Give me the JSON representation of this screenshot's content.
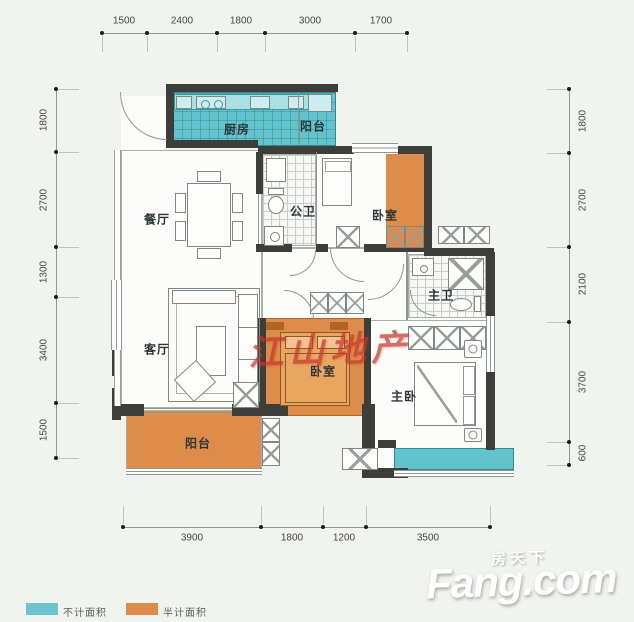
{
  "colors": {
    "cyan": "#63c3cc",
    "orange": "#de8c49",
    "wall": "#3d3e3a",
    "background": "#f1f3ee",
    "watermark_red": "#c4382e"
  },
  "dimensions": {
    "top": [
      "1500",
      "2400",
      "1800",
      "3000",
      "1700"
    ],
    "left": [
      "1800",
      "2700",
      "1300",
      "3400",
      "1500"
    ],
    "right": [
      "1800",
      "2700",
      "2100",
      "3700",
      "600"
    ],
    "bottom": [
      "3900",
      "1800",
      "1200",
      "3500"
    ]
  },
  "rooms": {
    "kitchen": "厨房",
    "balcony_top": "阳台",
    "dining": "餐厅",
    "bath_public": "公卫",
    "bedroom_top": "卧室",
    "bath_master": "主卫",
    "living": "客厅",
    "bedroom_mid": "卧室",
    "bedroom_master": "主卧",
    "balcony_bottom": "阳台"
  },
  "legend": {
    "not_counted": "不计面积",
    "half_counted": "半计面积"
  },
  "watermark": "江山地产",
  "logo": {
    "cn": "房天下",
    "en": "Fang.com"
  }
}
